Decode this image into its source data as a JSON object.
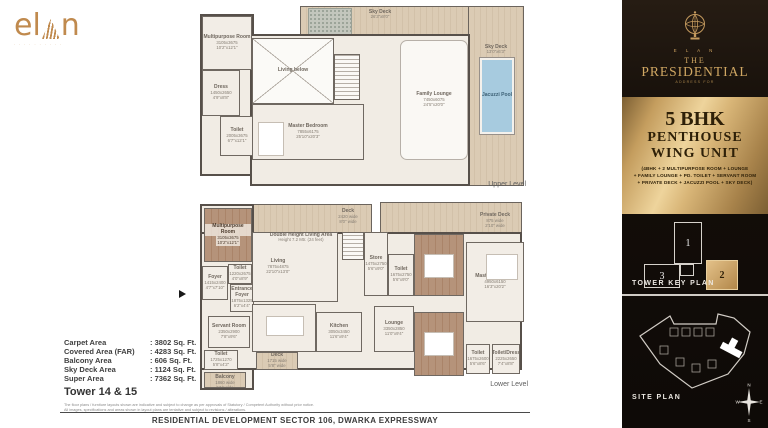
{
  "brand": {
    "logo_text_left": "el",
    "logo_text_right": "n",
    "logo_tagline": "∙ ∙ ∙ ∙ ∙ ∙ ∙ ∙ ∙ ∙"
  },
  "sidebar": {
    "crest_name": "elan-crest",
    "brand_small": "E L A N",
    "title_line1": "THE",
    "title_line2": "PRESIDENTIAL",
    "tagline": "ADDRESS FOR",
    "unit_card": {
      "line1": "5 BHK",
      "line2": "PENTHOUSE",
      "line3": "WING UNIT",
      "details_line1": "(4BHK + 2 MULTIPURPOSE ROOM + LOUNGE",
      "details_line2": "+ FAMILY LOUNGE + PD. TOILET + SERVANT ROOM",
      "details_line3": "+ PRIVATE DECK + JACUZZI POOL + SKY DECK)"
    },
    "tower_key_plan": {
      "label": "TOWER KEY PLAN",
      "towers": [
        {
          "num": "1"
        },
        {
          "num": "3"
        },
        {
          "num": "2"
        }
      ],
      "highlighted_tower": "2"
    },
    "site_plan": {
      "label": "SITE PLAN",
      "compass": {
        "n": "N",
        "s": "S",
        "e": "E",
        "w": "W"
      }
    }
  },
  "plans": {
    "upper": {
      "caption": "Upper Level",
      "rooms": [
        {
          "n": "Multipurpose Room",
          "d": [
            "3105x3675",
            "10'2\"x12'1\""
          ],
          "x": 10,
          "y": 12,
          "w": 50,
          "h": 54,
          "f": "base"
        },
        {
          "n": "Dress",
          "d": [
            "1450x2650",
            "4'9\"x8'8\""
          ],
          "x": 10,
          "y": 66,
          "w": 38,
          "h": 46,
          "f": "base"
        },
        {
          "n": "Toilet",
          "d": [
            "2005x3675",
            "6'7\"x12'1\""
          ],
          "x": 28,
          "y": 112,
          "w": 34,
          "h": 40,
          "f": "base"
        },
        {
          "n": "Living below",
          "d": [],
          "x": 60,
          "y": 34,
          "w": 82,
          "h": 66,
          "f": "void"
        },
        {
          "n": "",
          "d": [],
          "x": 142,
          "y": 50,
          "w": 26,
          "h": 46,
          "f": "stairs"
        },
        {
          "n": "Master Bedroom",
          "d": [
            "7855x6175",
            "25'10\"x20'3\""
          ],
          "x": 60,
          "y": 100,
          "w": 112,
          "h": 56,
          "f": "base"
        },
        {
          "n": "",
          "d": [],
          "x": 66,
          "y": 118,
          "w": 26,
          "h": 34,
          "f": "furn"
        },
        {
          "n": "Family Lounge",
          "d": [
            "7450x6075",
            "24'5\"x20'0\""
          ],
          "x": 208,
          "y": 36,
          "w": 68,
          "h": 120,
          "f": "white"
        },
        {
          "n": "Sky Deck",
          "d": [
            "26'3\"x8'0\""
          ],
          "x": 166,
          "y": 4,
          "w": 44,
          "h": 14,
          "f": "label"
        },
        {
          "n": "Sky Deck",
          "d": [
            "13'0\"x6'3\""
          ],
          "x": 282,
          "y": 40,
          "w": 44,
          "h": 12,
          "f": "label"
        },
        {
          "n": "Jacuzzi Pool",
          "d": [],
          "x": 288,
          "y": 54,
          "w": 34,
          "h": 76,
          "f": "pool"
        }
      ]
    },
    "lower": {
      "caption": "Lower Level",
      "rooms": [
        {
          "n": "Multipurpose Room",
          "d": [
            "3105x3675",
            "10'2\"x12'1\""
          ],
          "x": 18,
          "y": 12,
          "w": 48,
          "h": 54,
          "f": "wood"
        },
        {
          "n": "Foyer",
          "d": [
            "1415x2400",
            "4'7\"x7'10\""
          ],
          "x": 16,
          "y": 70,
          "w": 26,
          "h": 34,
          "f": "base"
        },
        {
          "n": "Toilet",
          "d": [
            "1220x2675",
            "4'0\"x8'9\""
          ],
          "x": 42,
          "y": 68,
          "w": 24,
          "h": 20,
          "f": "base"
        },
        {
          "n": "Entrance Foyer",
          "d": [
            "1875x1325",
            "6'2\"x4'4\""
          ],
          "x": 44,
          "y": 88,
          "w": 24,
          "h": 28,
          "f": "base"
        },
        {
          "n": "Servant Room",
          "d": [
            "2350x2900",
            "7'8\"x9'6\""
          ],
          "x": 22,
          "y": 120,
          "w": 42,
          "h": 32,
          "f": "base"
        },
        {
          "n": "Toilet",
          "d": [
            "1725x1270",
            "5'8\"x4'2\""
          ],
          "x": 18,
          "y": 154,
          "w": 34,
          "h": 20,
          "f": "base"
        },
        {
          "n": "HW/Utility Balcony",
          "d": [
            "1860 wide",
            "6'1\" wide"
          ],
          "x": 18,
          "y": 176,
          "w": 42,
          "h": 16,
          "f": "deck"
        },
        {
          "n": "",
          "d": [],
          "x": 66,
          "y": 36,
          "w": 86,
          "h": 70,
          "f": "base"
        },
        {
          "n": "Double Height Living Area",
          "d": [
            "Height 7.2 Mtr. (24 feet)"
          ],
          "x": 78,
          "y": 32,
          "w": 74,
          "h": 20,
          "f": "label"
        },
        {
          "n": "Living",
          "d": [
            "7875x4875",
            "22'10\"x13'0\""
          ],
          "x": 70,
          "y": 58,
          "w": 44,
          "h": 26,
          "f": "label"
        },
        {
          "n": "Dining",
          "d": [
            "4075x2875",
            "14'0\"x12'0\""
          ],
          "x": 66,
          "y": 108,
          "w": 64,
          "h": 48,
          "f": "base"
        },
        {
          "n": "",
          "d": [],
          "x": 80,
          "y": 120,
          "w": 38,
          "h": 20,
          "f": "furn"
        },
        {
          "n": "Kitchen",
          "d": [
            "3050x3450",
            "11'6\"x9'4\""
          ],
          "x": 130,
          "y": 116,
          "w": 46,
          "h": 40,
          "f": "base"
        },
        {
          "n": "Deck",
          "d": [
            "1715 wide",
            "5'8\" wide"
          ],
          "x": 70,
          "y": 156,
          "w": 42,
          "h": 18,
          "f": "deck"
        },
        {
          "n": "",
          "d": [],
          "x": 156,
          "y": 36,
          "w": 22,
          "h": 28,
          "f": "stairs"
        },
        {
          "n": "Store",
          "d": [
            "1475x2750",
            "5'6\"x9'0\""
          ],
          "x": 178,
          "y": 36,
          "w": 24,
          "h": 64,
          "f": "base"
        },
        {
          "n": "Lounge",
          "d": [
            "3350x2850",
            "11'0\"x9'4\""
          ],
          "x": 188,
          "y": 110,
          "w": 40,
          "h": 46,
          "f": "base"
        },
        {
          "n": "Toilet",
          "d": [
            "1675x2750",
            "5'6\"x9'0\""
          ],
          "x": 202,
          "y": 58,
          "w": 26,
          "h": 42,
          "f": "base"
        },
        {
          "n": "Bedroom 1",
          "d": [
            "3350x4875",
            "11'0\"x16'0\""
          ],
          "x": 228,
          "y": 38,
          "w": 50,
          "h": 62,
          "f": "wood"
        },
        {
          "n": "",
          "d": [],
          "x": 238,
          "y": 58,
          "w": 30,
          "h": 24,
          "f": "furn"
        },
        {
          "n": "Master Bedroom",
          "d": [
            "4950x6150",
            "16'3\"x20'2\""
          ],
          "x": 280,
          "y": 46,
          "w": 58,
          "h": 80,
          "f": "base"
        },
        {
          "n": "",
          "d": [],
          "x": 300,
          "y": 58,
          "w": 32,
          "h": 26,
          "f": "furn"
        },
        {
          "n": "Bedroom 2",
          "d": [
            "3350x4875",
            "11'0\"x16'0\""
          ],
          "x": 228,
          "y": 116,
          "w": 50,
          "h": 64,
          "f": "wood"
        },
        {
          "n": "",
          "d": [],
          "x": 238,
          "y": 136,
          "w": 30,
          "h": 24,
          "f": "furn"
        },
        {
          "n": "Toilet",
          "d": [
            "1675x2600",
            "5'6\"x8'6\""
          ],
          "x": 280,
          "y": 148,
          "w": 24,
          "h": 30,
          "f": "base"
        },
        {
          "n": "Toilet/Dress",
          "d": [
            "2225x2650",
            "7'4\"x8'8\""
          ],
          "x": 306,
          "y": 148,
          "w": 28,
          "h": 30,
          "f": "base"
        },
        {
          "n": "Private Deck",
          "d": [
            "875 wide",
            "2'10\" wide"
          ],
          "x": 282,
          "y": 12,
          "w": 54,
          "h": 26,
          "f": "label"
        },
        {
          "n": "Deck",
          "d": [
            "2420 wide",
            "8'0\" wide"
          ],
          "x": 140,
          "y": 10,
          "w": 44,
          "h": 22,
          "f": "label"
        }
      ]
    }
  },
  "area_table": {
    "rows": [
      {
        "label": "Carpet Area",
        "value": "3802 Sq. Ft."
      },
      {
        "label": "Covered Area (FAR)",
        "value": "4283 Sq. Ft."
      },
      {
        "label": "Balcony Area",
        "value": "606 Sq. Ft."
      },
      {
        "label": "Sky Deck Area",
        "value": "1124 Sq. Ft."
      },
      {
        "label": "Super Area",
        "value": "7362 Sq. Ft."
      }
    ]
  },
  "tower_label": "Tower 14 & 15",
  "disclaimer_line1": "The floor plans / furniture layouts shown are indicative and subject to change as per approvals of Statutory / Competent Authority without prior notice.",
  "disclaimer_line2": "All images, specifications and areas shown in layout plans are tentative and subject to revisions / alterations.",
  "footer": "RESIDENTIAL DEVELOPMENT SECTOR 106, DWARKA EXPRESSWAY",
  "colors": {
    "gold": "#c08a4e",
    "gold_panel": "#d9b678",
    "sidebar_bg": "#140e09",
    "pool_blue": "#a7cbdf",
    "wall": "#57504a",
    "deck_tan": "#dbcbb4",
    "wood_brown": "#b5937a"
  }
}
